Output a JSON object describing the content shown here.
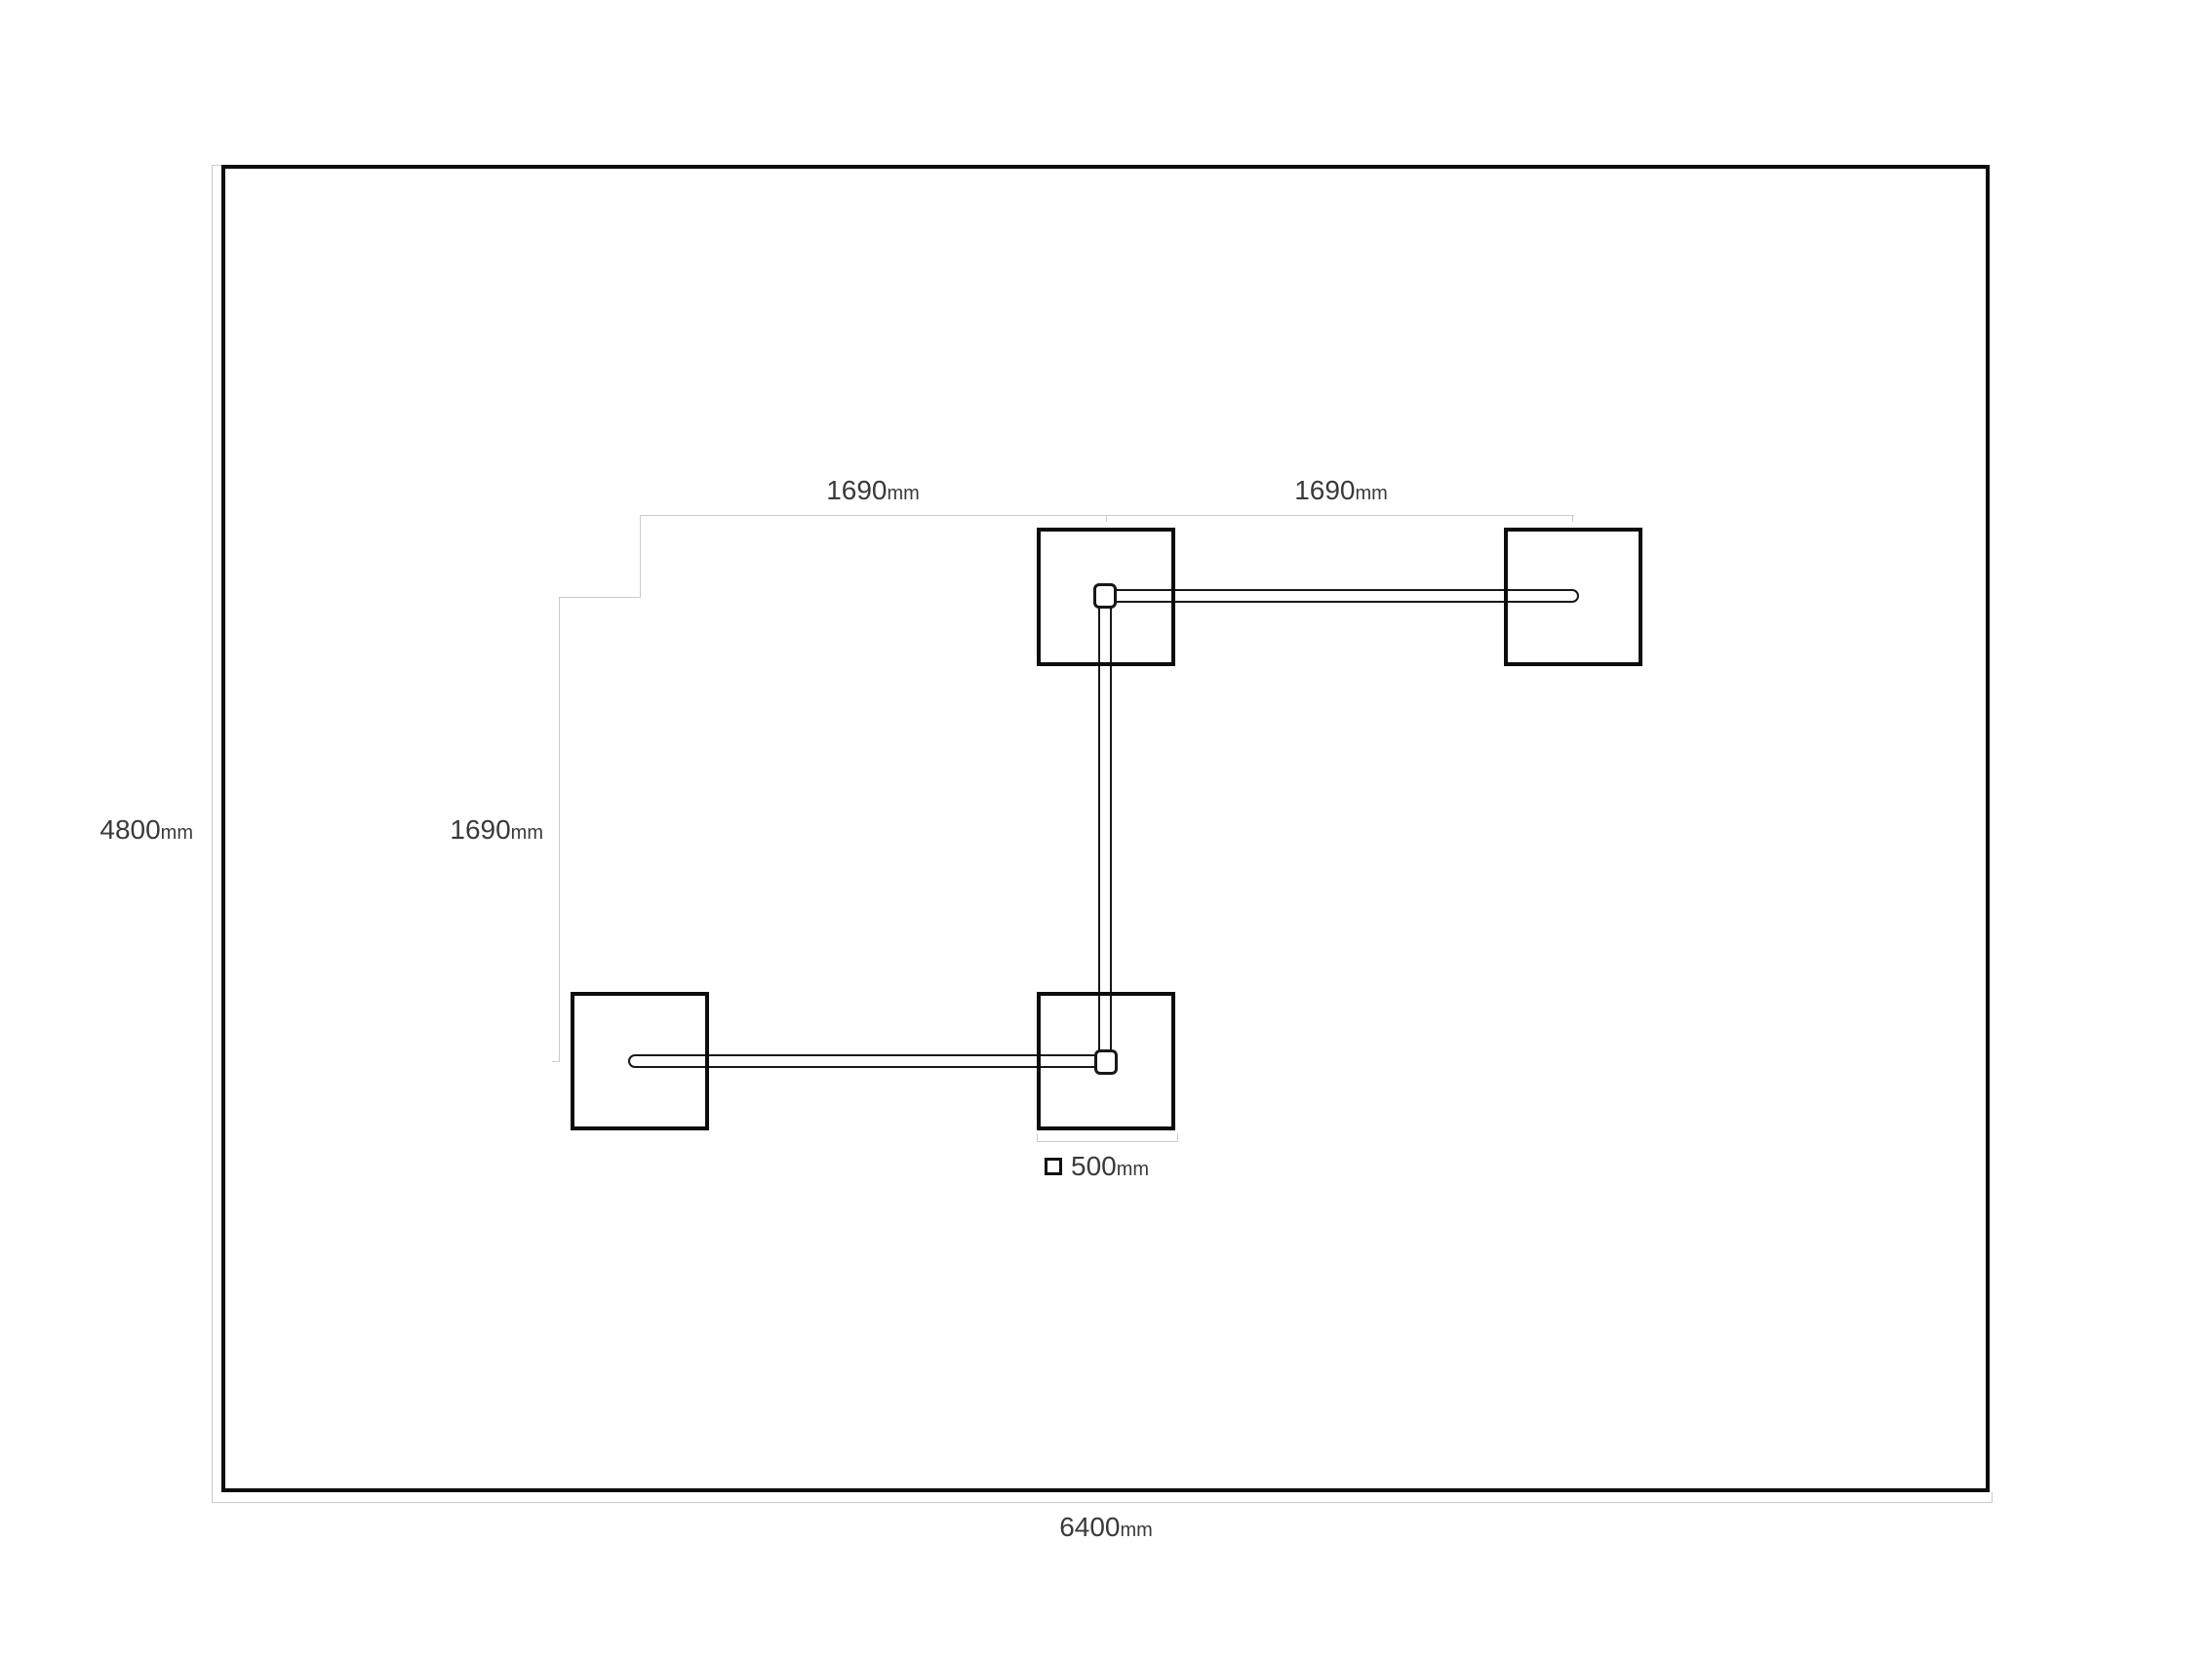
{
  "colors": {
    "background": "#ffffff",
    "outline_black": "#0d0d0d",
    "cable_black": "#181818",
    "dimension_gray": "#c9cdca",
    "text_gray": "#3a3a3a"
  },
  "room": {
    "height_label": {
      "value": "4800",
      "unit": "mm"
    },
    "width_label": {
      "value": "6400",
      "unit": "mm"
    }
  },
  "dimensions": {
    "top_left": {
      "value": "1690",
      "unit": "mm"
    },
    "top_right": {
      "value": "1690",
      "unit": "mm"
    },
    "left": {
      "value": "1690",
      "unit": "mm"
    }
  },
  "legend": {
    "panel_size": {
      "value": "500",
      "unit": "mm"
    }
  },
  "panels": [
    {
      "id": "top-center"
    },
    {
      "id": "top-right"
    },
    {
      "id": "bottom-left"
    },
    {
      "id": "bottom-center"
    }
  ]
}
